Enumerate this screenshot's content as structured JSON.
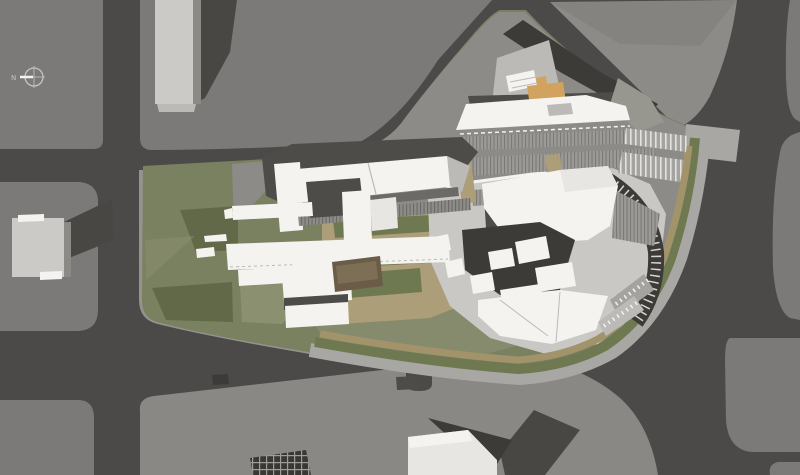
{
  "scene": {
    "title": "Aerial architectural site plan rendering"
  },
  "north_indicator": {
    "label": "N"
  },
  "palette": {
    "road": "#4b4a48",
    "block": "#7b7a78",
    "block_light": "#8c8b88",
    "block_bottom": "#898885",
    "sidewalk": "#94938e",
    "lawn": "#7a8161",
    "lawn_dark": "#616949",
    "lawn_light": "#8a9070",
    "garden": "#6e7951",
    "plaza_tan": "#ac9e79",
    "path_tan": "#a2936b",
    "plaza_east": "#c9c8c4",
    "promenade": "#a8a7a3",
    "white": "#f4f3f0",
    "white_dim": "#e7e6e2",
    "facet": "#bbbab6",
    "gray_roof": "#97968f",
    "dark": "#3c3b38",
    "charcoal": "#4d4c49",
    "orange": "#d2a35e",
    "orange_dark": "#b47f3c",
    "brown_steps": "#6b5c47",
    "brown_steps_light": "#7d6e56",
    "rib_base": "#9b9a96",
    "rib_line": "#7b7a76",
    "ribd_base": "#8d8c88",
    "ribd_line": "#6b6a66",
    "park_base": "#a4a39f",
    "park_line": "#e3e2de",
    "tick": "#d7d6d2",
    "shadow": "#484744",
    "grid_dark": "#393835",
    "grid_line": "#9e9d99",
    "bldg_face": "#cbcac7",
    "bldg_side": "#8b8a85",
    "north": "#c6c5c1"
  }
}
